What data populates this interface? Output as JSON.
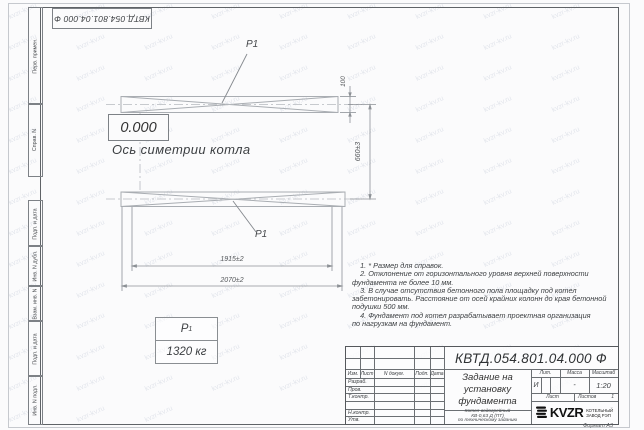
{
  "sheet": {
    "watermark": "kvzr-kv.ru",
    "stamp_top_left": "КВТД.054.801.04.000  Ф",
    "format_note": "Формат А3",
    "sidebar": {
      "items": [
        "Перв. примен.",
        "Справ. N",
        "Подп. и дата",
        "Инв. N дубл.",
        "Взам. инв. N",
        "Подп. и дата",
        "Инв. N подл."
      ]
    }
  },
  "drawing": {
    "elevation_mark": "0.000",
    "axis_caption": "Ось симетрии котла",
    "position_label_top": "P1",
    "position_label_bottom": "P1",
    "dimensions": {
      "beam_height": "100",
      "beam_spacing": "660±3",
      "anchor_span": "1915±2",
      "overall_length": "2070±2"
    },
    "load_table": {
      "symbol": "P",
      "symbol_sub": "1",
      "value": "1320 кг"
    }
  },
  "notes": {
    "text": "    1. * Размер для справок.\n    2. Отклонение от горизонтального уровня верхней поверхности\nфундамента не более 10 мм.\n    3. В случае отсутствия бетонного пола площадку под котел\nзабетонировать. Расстояние от осей крайних колонн до края бетонной\nподушки 500 мм.\n    4. Фундамент под котел разрабатывает проектная организация\nпо нагрузкам на фундамент."
  },
  "title_block": {
    "doc_number": "КВТД.054.801.04.000  Ф",
    "title": "Задание на\nустановку\nфундамента",
    "subtitle": "Котел водогрейный\nКВ-0,63 Д (ПТ)\nпо техническому заданию",
    "header_cols": {
      "izm": "Изм.",
      "list": "Лист",
      "doc": "N докум.",
      "podp": "Подп.",
      "data": "Дата"
    },
    "signature_rows": [
      "Разраб.",
      "Пров.",
      "Т.контр.",
      "",
      "Н.контр.",
      "Утв."
    ],
    "lit": {
      "label": "Лит.",
      "value": "И"
    },
    "mass": {
      "label": "Масса",
      "value": "-"
    },
    "scale": {
      "label": "Масштаб",
      "value": "1:20"
    },
    "sheet": {
      "label": "Лист",
      "value": ""
    },
    "sheets": {
      "label": "Листов",
      "value": "1"
    },
    "company": {
      "logo_text": "KVZR",
      "name_line1": "КОТЕЛЬНЫЙ",
      "name_line2": "ЗАВОД  РЭП"
    }
  }
}
